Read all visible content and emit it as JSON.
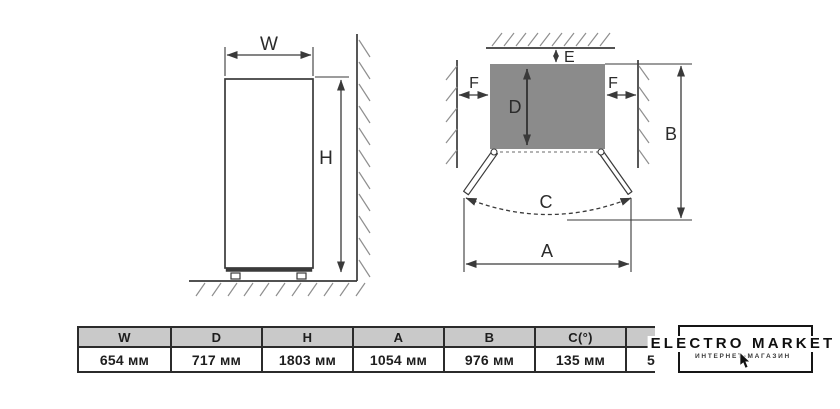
{
  "front_view": {
    "width_label": "W",
    "height_label": "H"
  },
  "top_view": {
    "rear_clearance_label": "E",
    "left_clearance_label": "F",
    "right_clearance_label": "F",
    "depth_label": "D",
    "door_swing_label": "C",
    "total_depth_label": "B",
    "doors_open_width_label": "A"
  },
  "spec_table": {
    "columns": [
      {
        "header": "W",
        "value": "654 мм"
      },
      {
        "header": "D",
        "value": "717 мм"
      },
      {
        "header": "H",
        "value": "1803 мм"
      },
      {
        "header": "A",
        "value": "1054 мм"
      },
      {
        "header": "B",
        "value": "976 мм"
      },
      {
        "header": "C(°)",
        "value": "135 мм"
      },
      {
        "header": "",
        "value": "5"
      }
    ]
  },
  "logo": {
    "title": "ELECTRO MARKET",
    "subtitle": "ИНТЕРНЕТ-МАГАЗИН",
    "icon": "mouse-pointer-arrow"
  },
  "colors": {
    "line": "#3a3a3a",
    "hatch": "#8f8f8f",
    "cabinet_fill": "#8b8b8b",
    "table_header_fill": "#c9c9c9",
    "logo_black": "#151515",
    "background": "#ffffff"
  }
}
